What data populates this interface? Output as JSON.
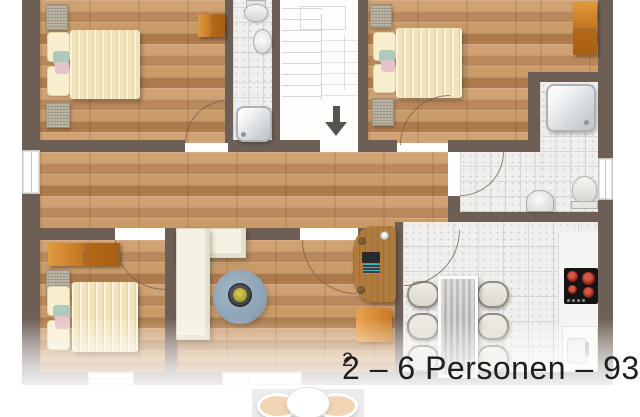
{
  "caption": {
    "text": "2 – 6 Personen – 93 m",
    "superscript": "2",
    "full": "2 – 6 Personen – 93 m²"
  },
  "colors": {
    "wall": "#6e5f56",
    "wood": "#c79d6e",
    "tile": "#f0efed",
    "tile_line": "#d8d7d3",
    "stair": "#fdfdfc",
    "wardrobe_orange": "#c4761f",
    "bed_duvet": "#f1e3b9",
    "bed_pillow": "#f7eecd",
    "accent_teal": "#afc9bd",
    "accent_pink": "#e6c3ca",
    "sofa": "#f5f1e2",
    "rug": "#8ea5b7",
    "stove": "#141414",
    "burner": "#a22820",
    "chair": "#e9e6de",
    "caption_text": "#1f1f1f",
    "lower_chair": "#f2d5b5",
    "arrow": "#59534d"
  },
  "floor_plan": {
    "level_shown": "upper floor, cropped at top and faded at bottom",
    "rooms": [
      {
        "name": "bedroom-top-left",
        "floor": "wood",
        "furniture": [
          "double-bed",
          "pillows",
          "bedside-mats",
          "wardrobe"
        ]
      },
      {
        "name": "bathroom-small",
        "floor": "tile",
        "furniture": [
          "toilet",
          "washbasin",
          "shower"
        ]
      },
      {
        "name": "stairwell",
        "floor": "white",
        "furniture": [
          "stair-treads",
          "landing",
          "down-arrow"
        ]
      },
      {
        "name": "bedroom-top-right",
        "floor": "wood",
        "furniture": [
          "double-bed",
          "pillows",
          "bedside-mats",
          "wardrobe"
        ]
      },
      {
        "name": "bathroom-main",
        "floor": "tile",
        "furniture": [
          "shower",
          "washbasin",
          "toilet",
          "window"
        ]
      },
      {
        "name": "hallway",
        "floor": "wood",
        "furniture": []
      },
      {
        "name": "bedroom-bottom-left",
        "floor": "wood",
        "furniture": [
          "double-bed",
          "pillows",
          "bedside-mat",
          "wardrobe",
          "window"
        ]
      },
      {
        "name": "living-room",
        "floor": "wood",
        "furniture": [
          "corner-sofa",
          "round-rug",
          "coffee-table",
          "plant",
          "desk",
          "laptop",
          "desk-chair",
          "window"
        ]
      },
      {
        "name": "kitchen-dining",
        "floor": "tile",
        "furniture": [
          "dining-table",
          "dining-chairs-x6",
          "counter",
          "cooktop",
          "kitchen-sink"
        ]
      }
    ],
    "lower_floor_preview": [
      "dining-table",
      "two-chairs"
    ]
  }
}
